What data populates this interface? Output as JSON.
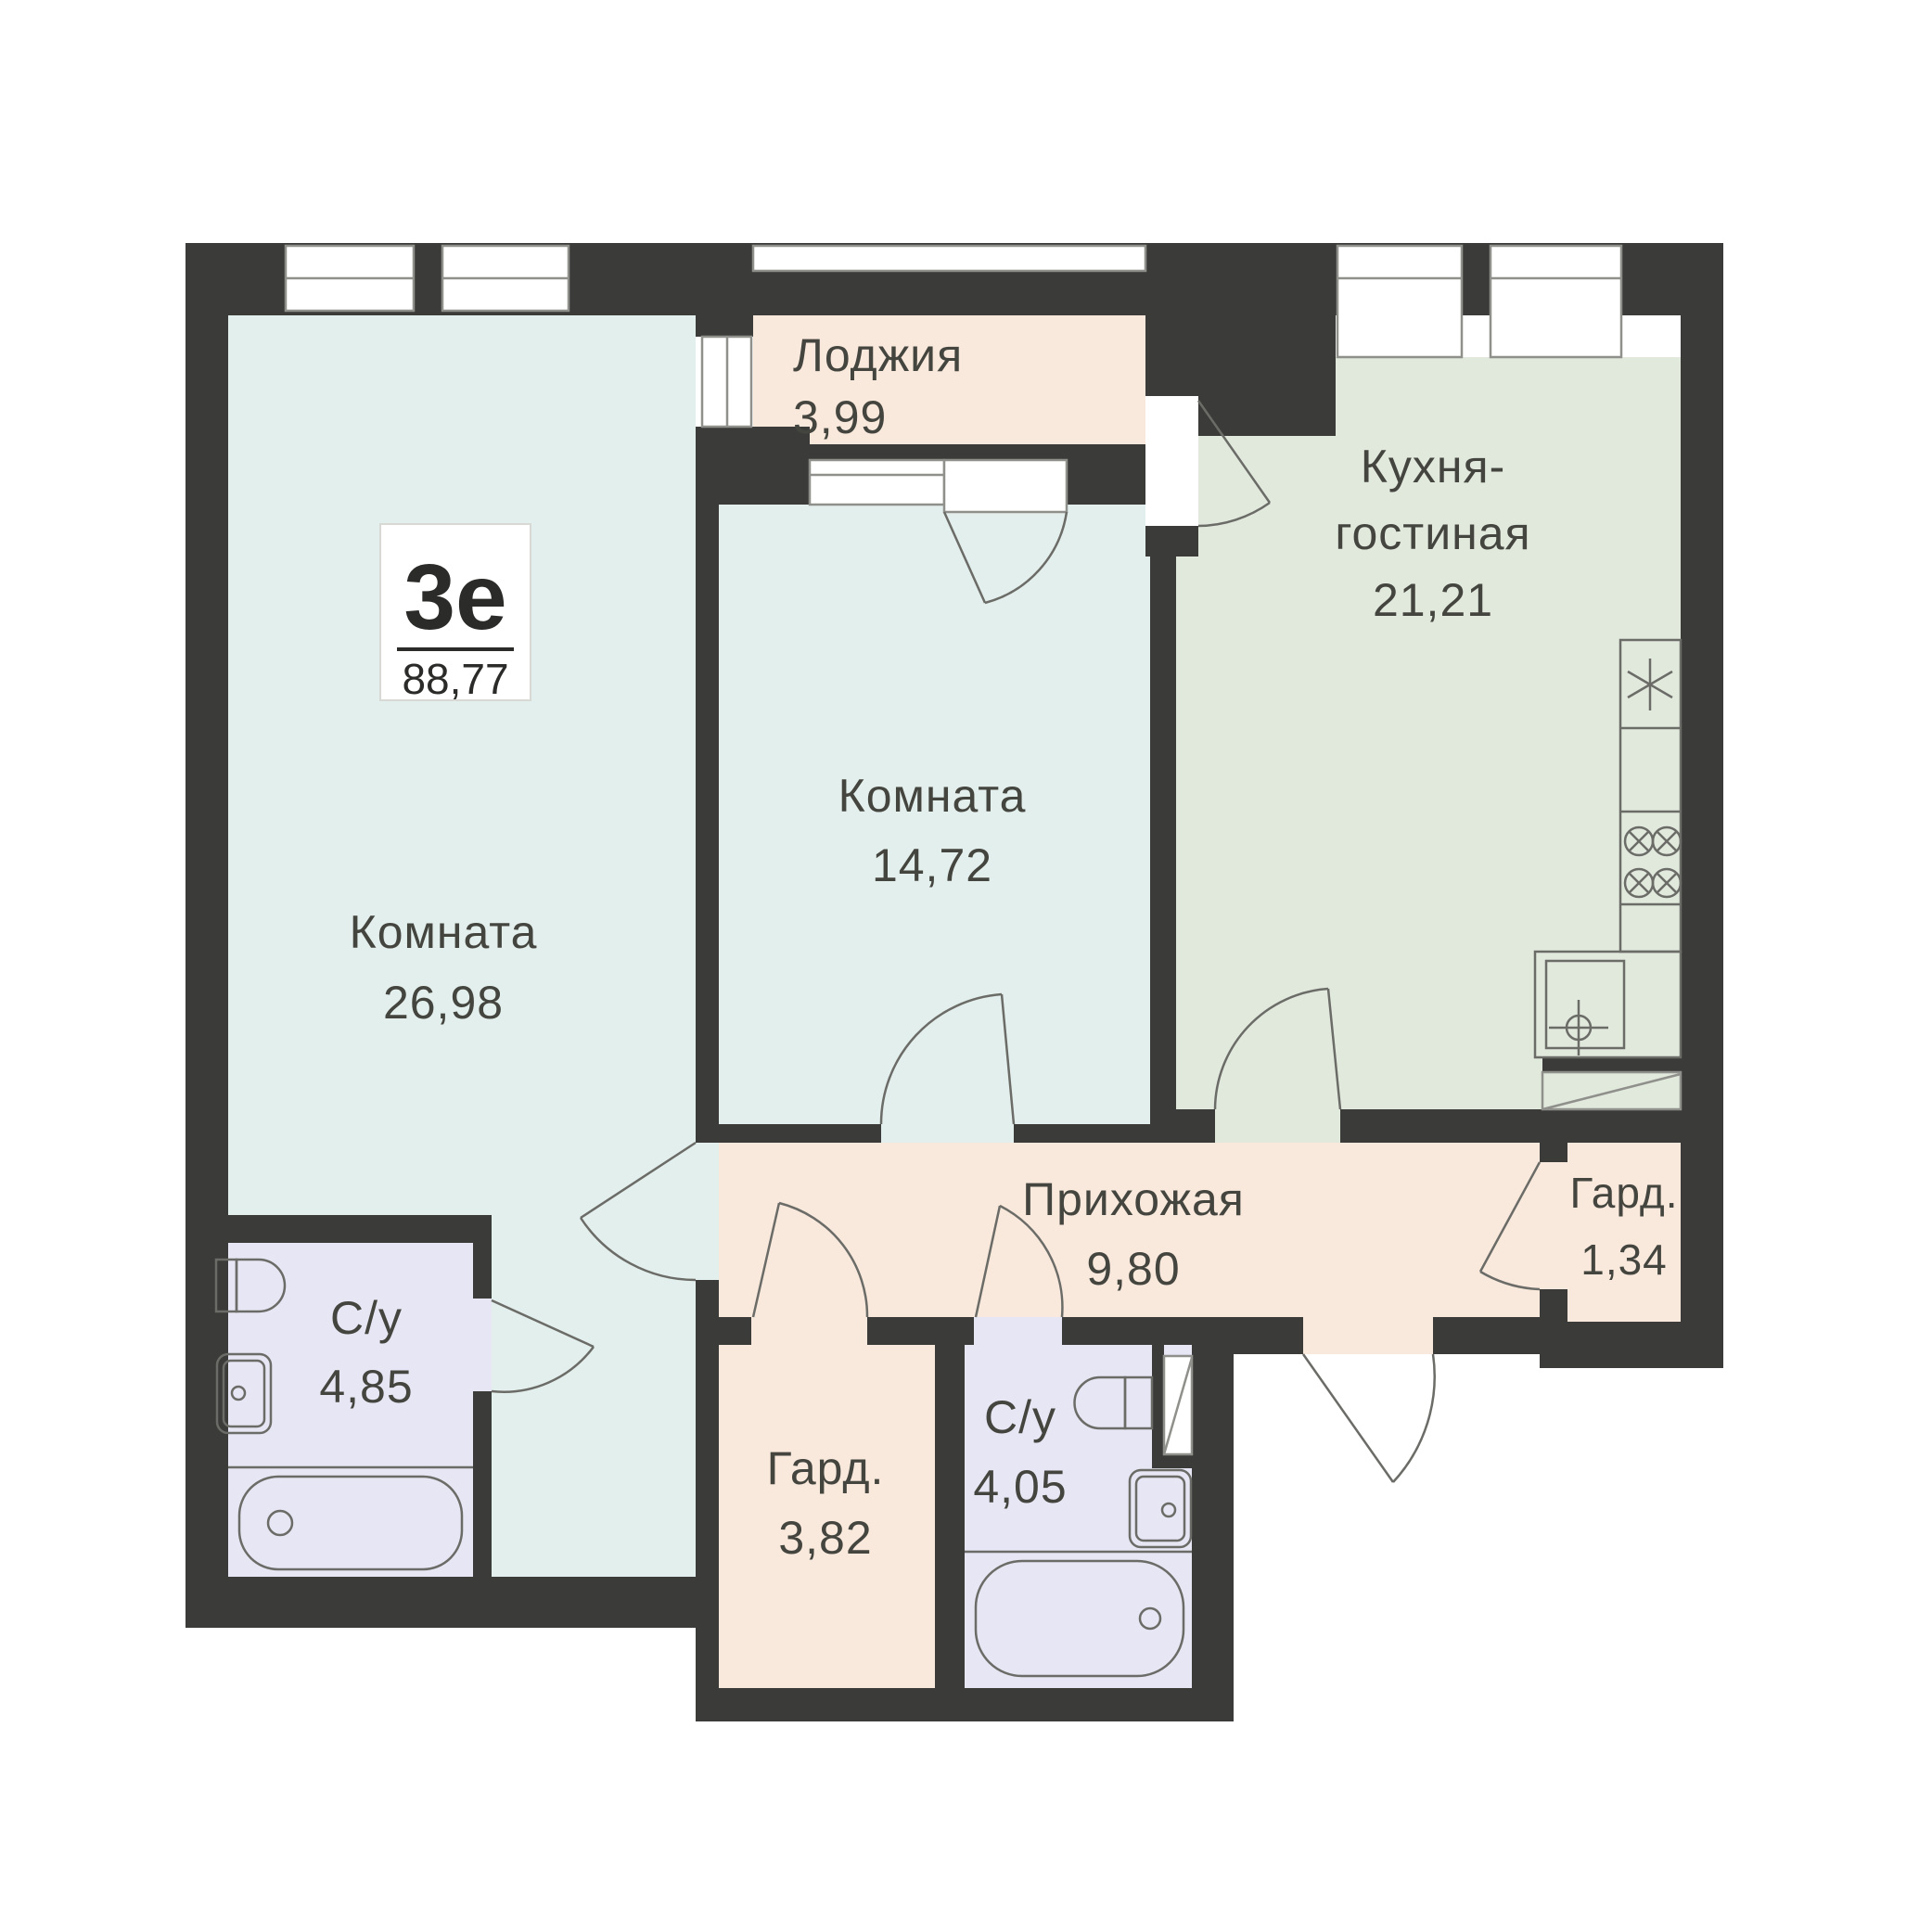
{
  "plan": {
    "badge": {
      "type_label": "3е",
      "total_area": "88,77"
    },
    "rooms": {
      "room_big": {
        "name": "Комната",
        "area": "26,98"
      },
      "room_mid": {
        "name": "Комната",
        "area": "14,72"
      },
      "kitchen": {
        "name_line1": "Кухня-",
        "name_line2": "гостиная",
        "area": "21,21"
      },
      "loggia": {
        "name": "Лоджия",
        "area": "3,99"
      },
      "hallway": {
        "name": "Прихожая",
        "area": "9,80"
      },
      "wardrobe_small": {
        "name": "Гард.",
        "area": "1,34"
      },
      "bathroom_left": {
        "name": "С/у",
        "area": "4,85"
      },
      "wardrobe_big": {
        "name": "Гард.",
        "area": "3,82"
      },
      "bathroom_mid": {
        "name": "С/у",
        "area": "4,05"
      }
    },
    "fixtures": [
      "fridge-icon",
      "stove-burners-icon",
      "kitchen-sink-icon",
      "toilet-icon",
      "washbasin-icon",
      "bathtub-icon",
      "door-swing-icon",
      "duct-shaft-icon"
    ],
    "palette": {
      "bg": "#ffffff",
      "wall": "#3b3b39",
      "room_cyan": "#e3efed",
      "kitchen_green": "#e1e9dd",
      "peach": "#f8e9dc",
      "lavender": "#e6e6f4",
      "text": "#45453f",
      "fixture": "#6b6b67",
      "frame": "#8f8f8b",
      "badge_text": "#2b2b29",
      "badge_border": "#d8d8d4"
    }
  }
}
